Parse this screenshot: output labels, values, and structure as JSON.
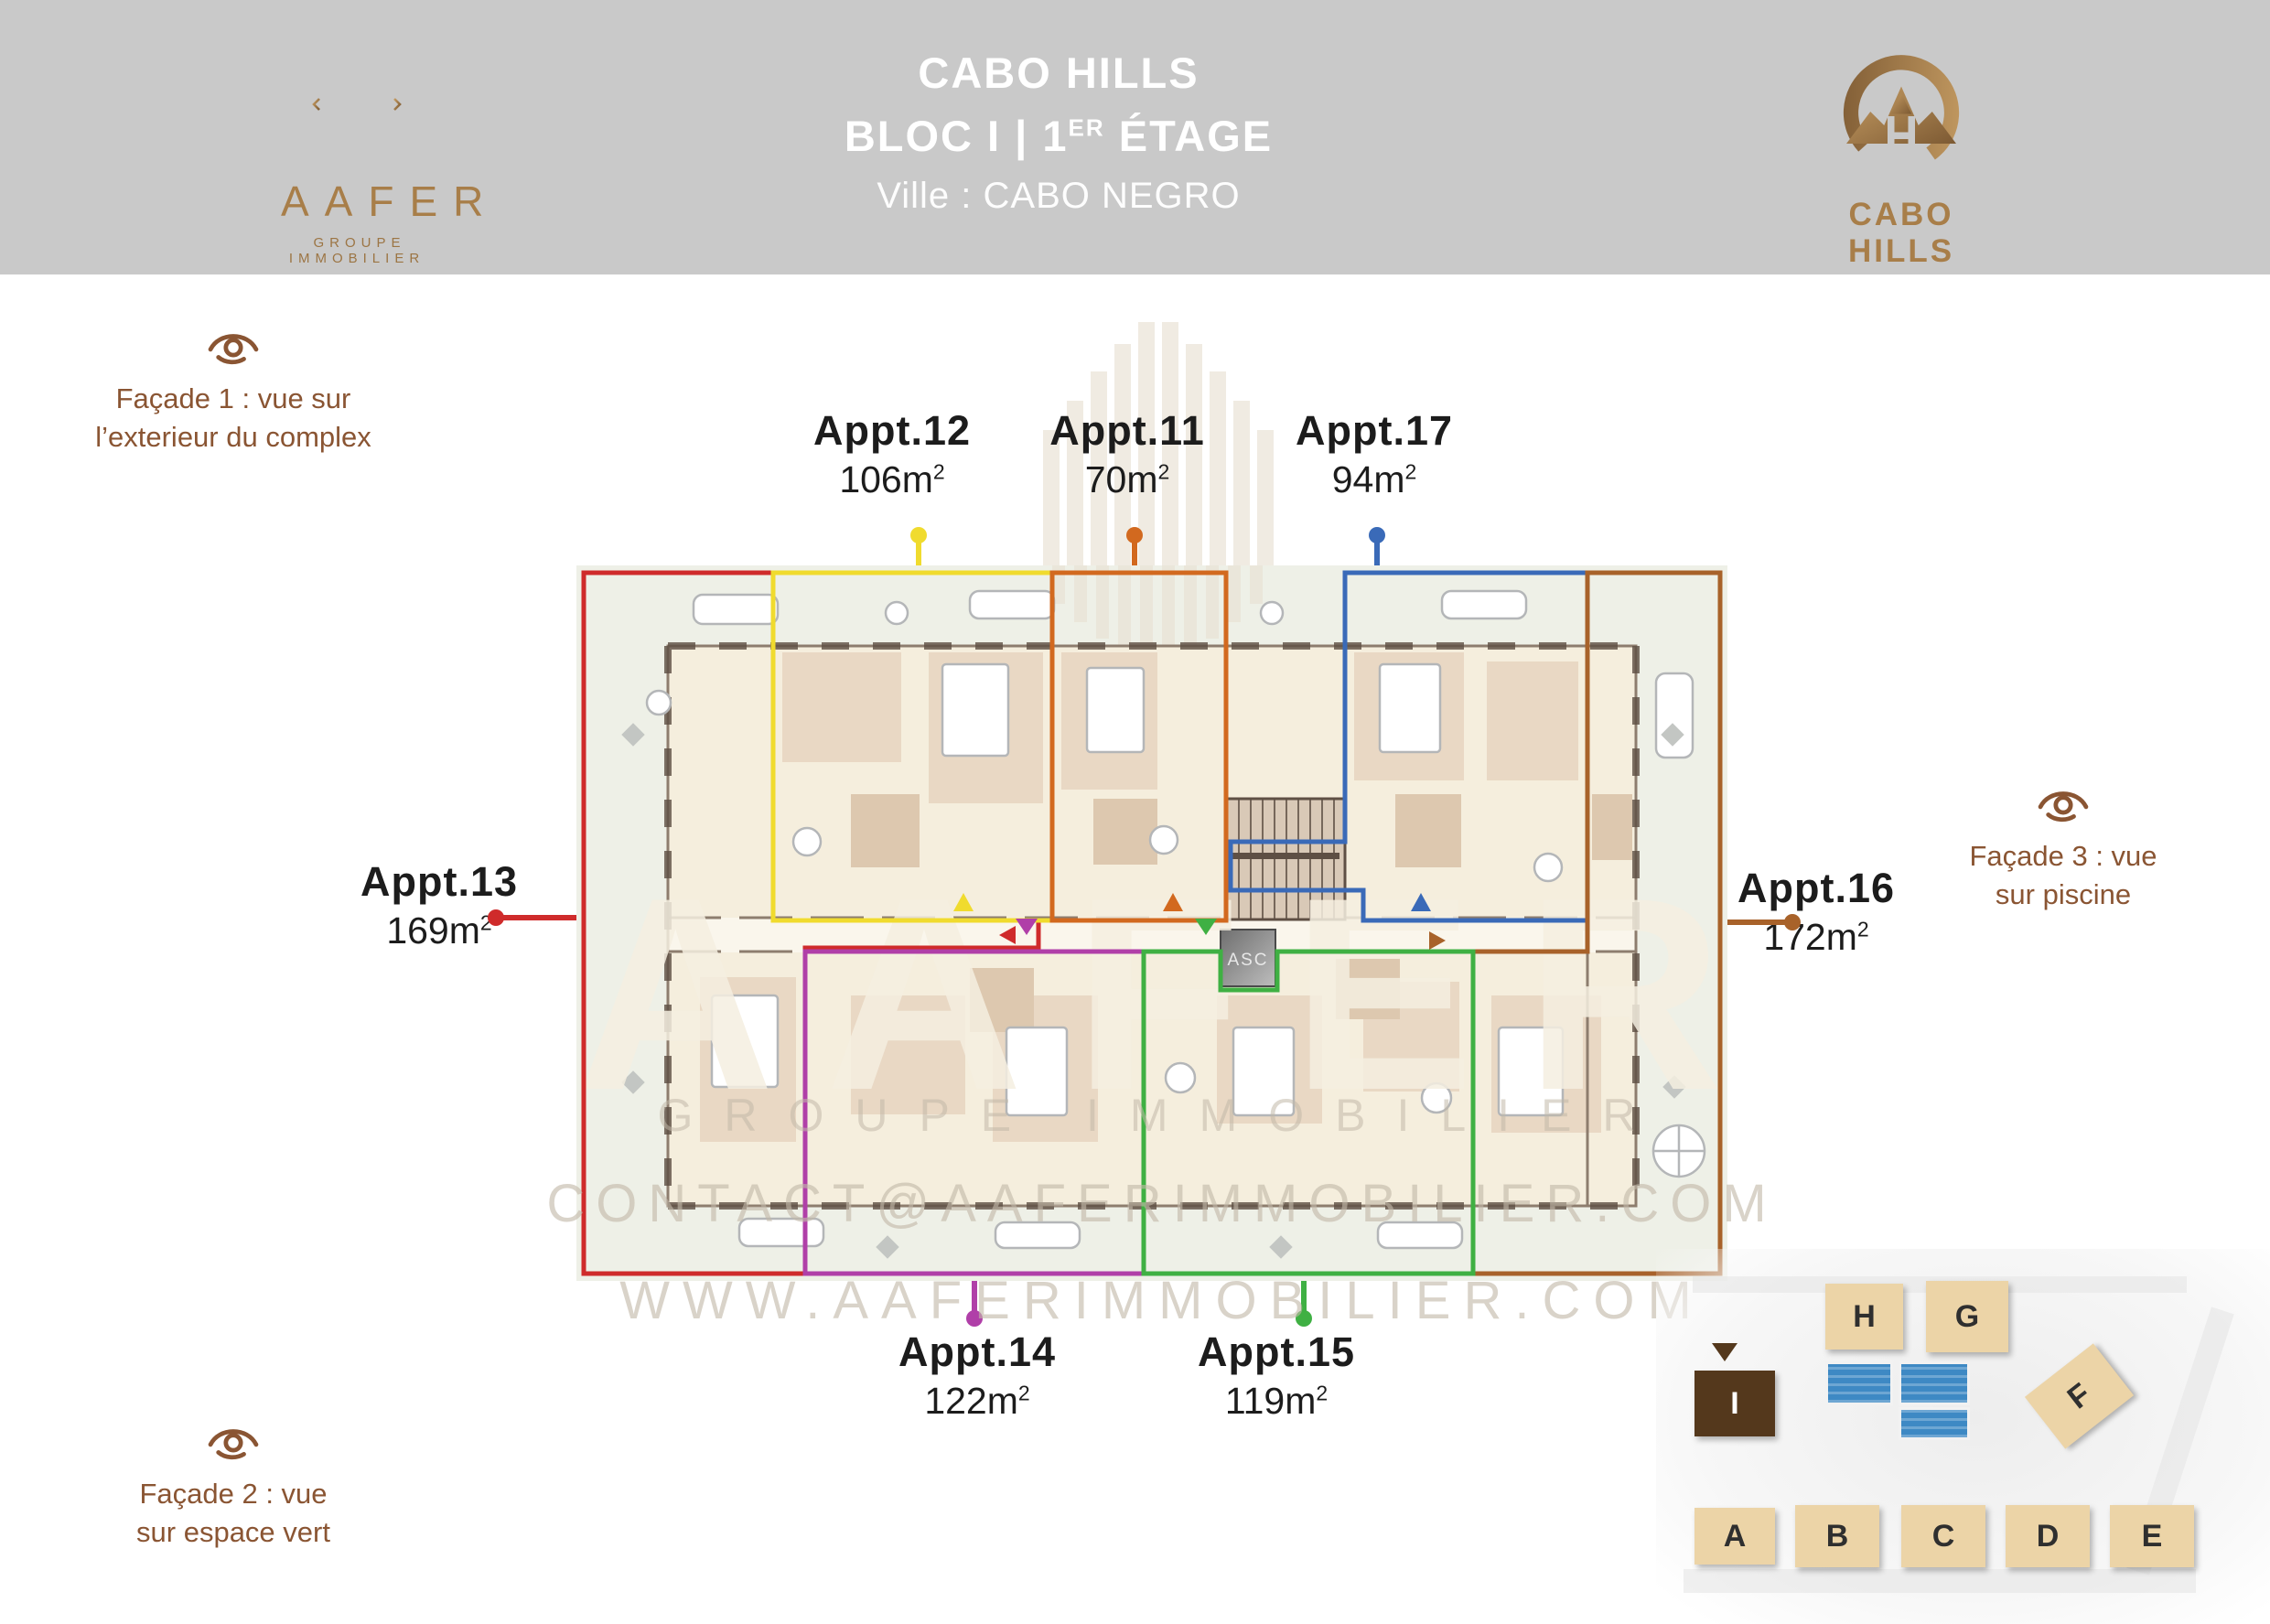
{
  "header": {
    "title": "CABO HILLS",
    "bloc_pre": "BLOC I | 1",
    "bloc_sup": "ER",
    "bloc_post": " ÉTAGE",
    "city": "Ville : CABO NEGRO",
    "band_color": "#c9c9c9"
  },
  "aafer_logo": {
    "name": "AAFER",
    "tagline": "GROUPE IMMOBILIER",
    "gold": "#a87e49"
  },
  "cabo_logo": {
    "name": "CABO HILLS",
    "gold": "#a87e49"
  },
  "facades": [
    {
      "line1": "Façade 1 : vue sur",
      "line2": "l’exterieur du complex"
    },
    {
      "line1": "Façade 2 : vue",
      "line2": "sur espace vert"
    },
    {
      "line1": "Façade 3 : vue",
      "line2": "sur piscine"
    }
  ],
  "facade_color": "#8a5533",
  "apartments": [
    {
      "name": "Appt.12",
      "area_main": "106m",
      "area_sup": "2",
      "color": "#f0db2e"
    },
    {
      "name": "Appt.11",
      "area_main": "70m",
      "area_sup": "2",
      "color": "#d2691f"
    },
    {
      "name": "Appt.17",
      "area_main": "94m",
      "area_sup": "2",
      "color": "#3a6ab8"
    },
    {
      "name": "Appt.13",
      "area_main": "169m",
      "area_sup": "2",
      "color": "#cf2b2b"
    },
    {
      "name": "Appt.16",
      "area_main": "172m",
      "area_sup": "2",
      "color": "#a8622a"
    },
    {
      "name": "Appt.14",
      "area_main": "122m",
      "area_sup": "2",
      "color": "#b03fa8"
    },
    {
      "name": "Appt.15",
      "area_main": "119m",
      "area_sup": "2",
      "color": "#3fb043"
    }
  ],
  "plan": {
    "elevator_label": "ASC"
  },
  "watermark": {
    "big": "AAFER",
    "line1": "GROUPE IMMOBILIER",
    "line2": "CONTACT@AAFERIMMOBILIER.COM",
    "line3": "WWW.AAFERIMMOBILIER.COM"
  },
  "site_map": {
    "highlighted_block": "I",
    "blocks": [
      "H",
      "G",
      "F",
      "I",
      "A",
      "B",
      "C",
      "D",
      "E"
    ],
    "pool_color": "#3e89c4"
  }
}
